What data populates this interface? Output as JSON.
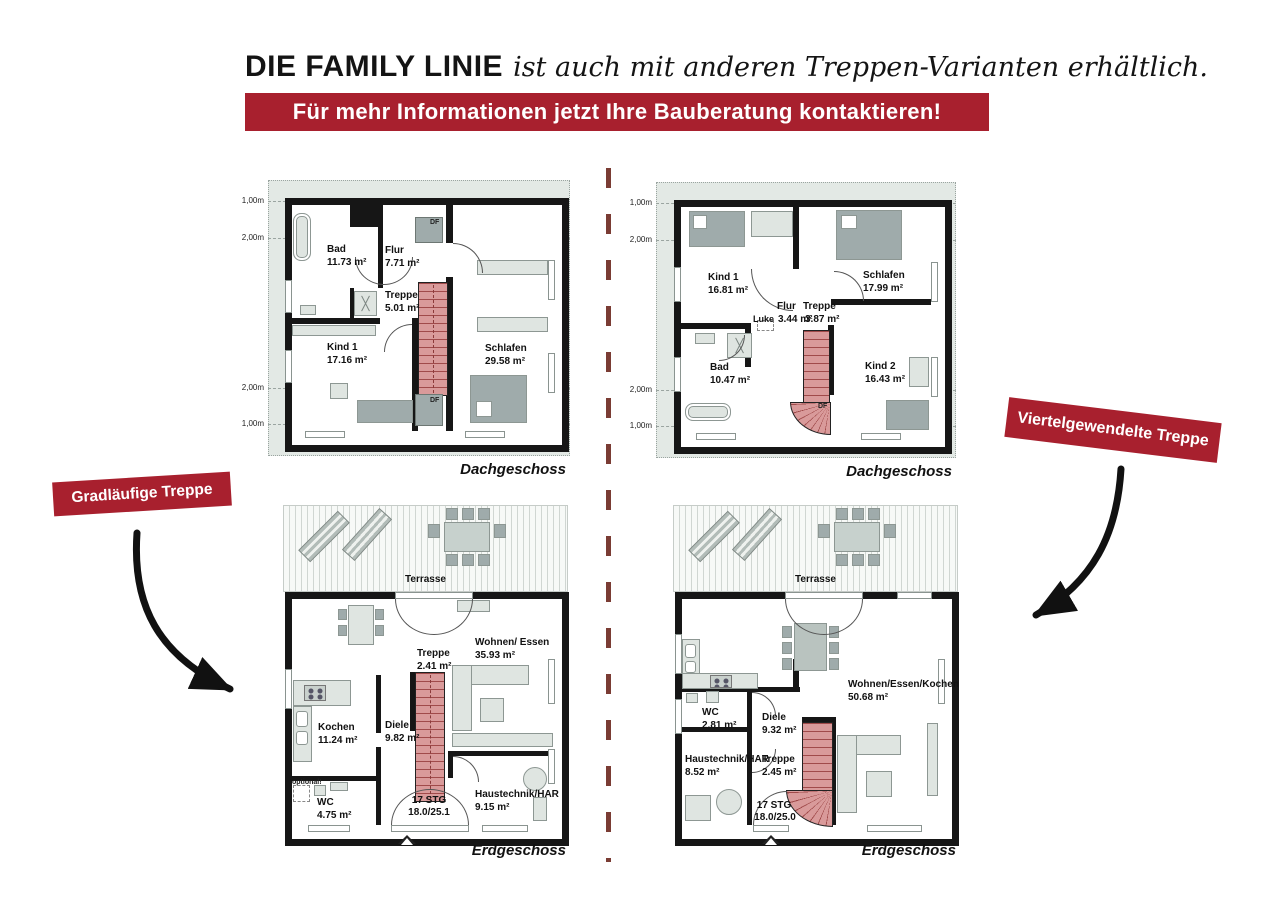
{
  "header": {
    "brand": "DIE FAMILY LINIE",
    "tagline": "ist auch mit anderen Treppen-Varianten erhältlich.",
    "banner": "Für mehr Informationen jetzt Ihre Bauberatung kontaktieren!"
  },
  "badges": {
    "left": "Gradläufige Treppe",
    "right": "Viertelgewendelte Treppe"
  },
  "colors": {
    "accent_red": "#a8202e",
    "divider_maroon": "#7a3c34",
    "stair_pink": "#d99a9a"
  },
  "plans": {
    "dg_left": {
      "floor": "Dachgeschoss",
      "dims": [
        "1,00m",
        "2,00m",
        "2,00m",
        "1,00m"
      ],
      "df": "DF",
      "rooms": {
        "bad": {
          "name": "Bad",
          "area": "11.73 m²"
        },
        "flur": {
          "name": "Flur",
          "area": "7.71 m²"
        },
        "treppe": {
          "name": "Treppe",
          "area": "5.01 m²"
        },
        "kind1": {
          "name": "Kind 1",
          "area": "17.16 m²"
        },
        "schlafen": {
          "name": "Schlafen",
          "area": "29.58 m²"
        }
      }
    },
    "dg_right": {
      "floor": "Dachgeschoss",
      "dims": [
        "1,00m",
        "2,00m",
        "2,00m",
        "1,00m"
      ],
      "df": "DF",
      "luke": "Luke",
      "rooms": {
        "kind1": {
          "name": "Kind 1",
          "area": "16.81 m²"
        },
        "schlafen": {
          "name": "Schlafen",
          "area": "17.99 m²"
        },
        "flur": {
          "name": "Flur",
          "area": "3.44 m²"
        },
        "treppe": {
          "name": "Treppe",
          "area": "3.87 m²"
        },
        "bad": {
          "name": "Bad",
          "area": "10.47 m²"
        },
        "kind2": {
          "name": "Kind 2",
          "area": "16.43 m²"
        }
      }
    },
    "eg_left": {
      "floor": "Erdgeschoss",
      "terrace": "Terrasse",
      "optional": "optional!",
      "stg": "17 STG",
      "ratio": "18.0/25.1",
      "rooms": {
        "treppe": {
          "name": "Treppe",
          "area": "2.41 m²"
        },
        "wohnen": {
          "name": "Wohnen/ Essen",
          "area": "35.93 m²"
        },
        "kochen": {
          "name": "Kochen",
          "area": "11.24 m²"
        },
        "diele": {
          "name": "Diele",
          "area": "9.82 m²"
        },
        "wc": {
          "name": "WC",
          "area": "4.75 m²"
        },
        "haus": {
          "name": "Haustechnik/HAR",
          "area": "9.15 m²"
        }
      }
    },
    "eg_right": {
      "floor": "Erdgeschoss",
      "terrace": "Terrasse",
      "stg": "17 STG",
      "ratio": "18.0/25.0",
      "rooms": {
        "wc": {
          "name": "WC",
          "area": "2.81 m²"
        },
        "diele": {
          "name": "Diele",
          "area": "9.32 m²"
        },
        "wohnen": {
          "name": "Wohnen/Essen/Kochen",
          "area": "50.68 m²"
        },
        "haus": {
          "name": "Haustechnik/HAR",
          "area": "8.52 m²"
        },
        "treppe": {
          "name": "Treppe",
          "area": "2.45 m²"
        }
      }
    }
  }
}
